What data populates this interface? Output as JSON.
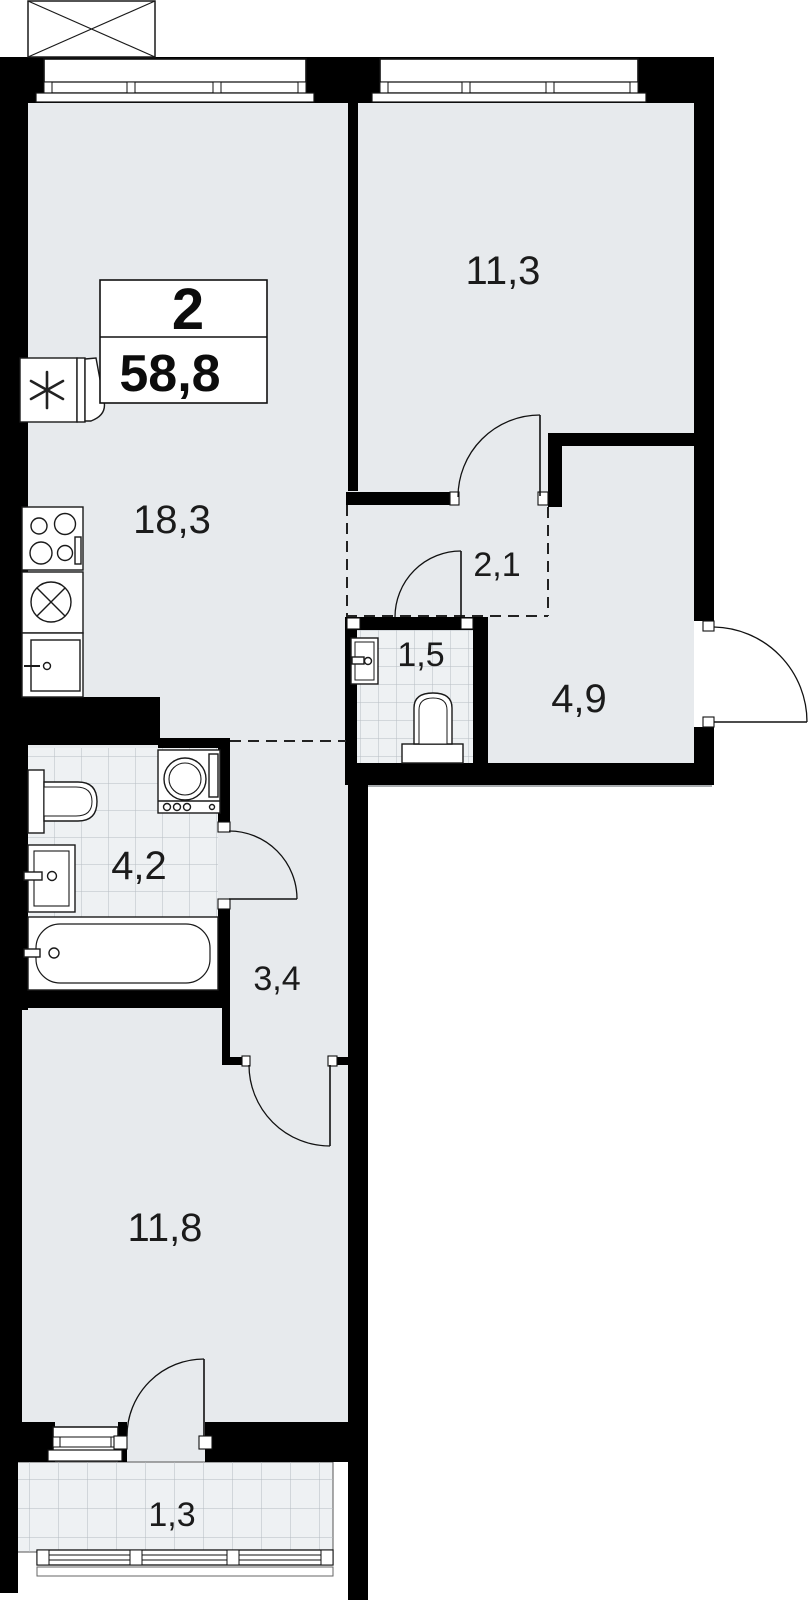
{
  "summary": {
    "room_count": "2",
    "total_area": "58,8"
  },
  "rooms": [
    {
      "name": "kitchen-living-room",
      "area": "18,3"
    },
    {
      "name": "bedroom-top",
      "area": "11,3"
    },
    {
      "name": "hall-zone",
      "area": "2,1"
    },
    {
      "name": "wc",
      "area": "1,5"
    },
    {
      "name": "entrance-hall",
      "area": "4,9"
    },
    {
      "name": "bathroom",
      "area": "4,2"
    },
    {
      "name": "corridor",
      "area": "3,4"
    },
    {
      "name": "bedroom-bottom",
      "area": "11,8"
    },
    {
      "name": "balcony",
      "area": "1,3"
    }
  ],
  "colors": {
    "wall": "#000000",
    "floor": "#e7eaed",
    "tile_floor": "#eef1f3",
    "tile_grid": "#b7bdc3",
    "background": "#ffffff",
    "line": "#1a1a1a"
  }
}
